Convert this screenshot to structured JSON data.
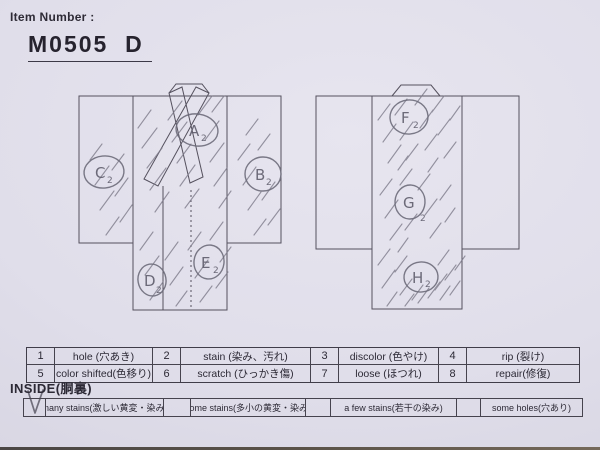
{
  "header": {
    "label": "Item Number :",
    "value": "M0505  D"
  },
  "diagram": {
    "front_markers": [
      {
        "letter": "A",
        "sub": "2"
      },
      {
        "letter": "B",
        "sub": "2"
      },
      {
        "letter": "C",
        "sub": "2"
      },
      {
        "letter": "D",
        "sub": "2"
      },
      {
        "letter": "E",
        "sub": "2"
      }
    ],
    "back_markers": [
      {
        "letter": "F",
        "sub": "2"
      },
      {
        "letter": "G",
        "sub": "2"
      },
      {
        "letter": "H",
        "sub": "2"
      }
    ]
  },
  "legend": {
    "items": [
      {
        "num": "1",
        "label": "hole (穴あき)"
      },
      {
        "num": "2",
        "label": "stain (染み、汚れ)"
      },
      {
        "num": "3",
        "label": "discolor (色やけ)"
      },
      {
        "num": "4",
        "label": "rip (裂け)"
      },
      {
        "num": "5",
        "label": "color shifted(色移り)"
      },
      {
        "num": "6",
        "label": "scratch (ひっかき傷)"
      },
      {
        "num": "7",
        "label": "loose (ほつれ)"
      },
      {
        "num": "8",
        "label": "repair(修復)"
      }
    ]
  },
  "inside": {
    "title": "INSIDE(胴裏)",
    "options": [
      {
        "label": "many stains(激しい黄変・染み)",
        "checked": true
      },
      {
        "label": "some stains(多小の黄変・染み)",
        "checked": false
      },
      {
        "label": "a few stains(若干の染み)",
        "checked": false
      },
      {
        "label": "some holes(穴あり)",
        "checked": false
      }
    ]
  },
  "colors": {
    "paper": "#e0deea",
    "print_line": "#55515e",
    "text": "#2c2935",
    "pencil": "#6d6b7a"
  }
}
